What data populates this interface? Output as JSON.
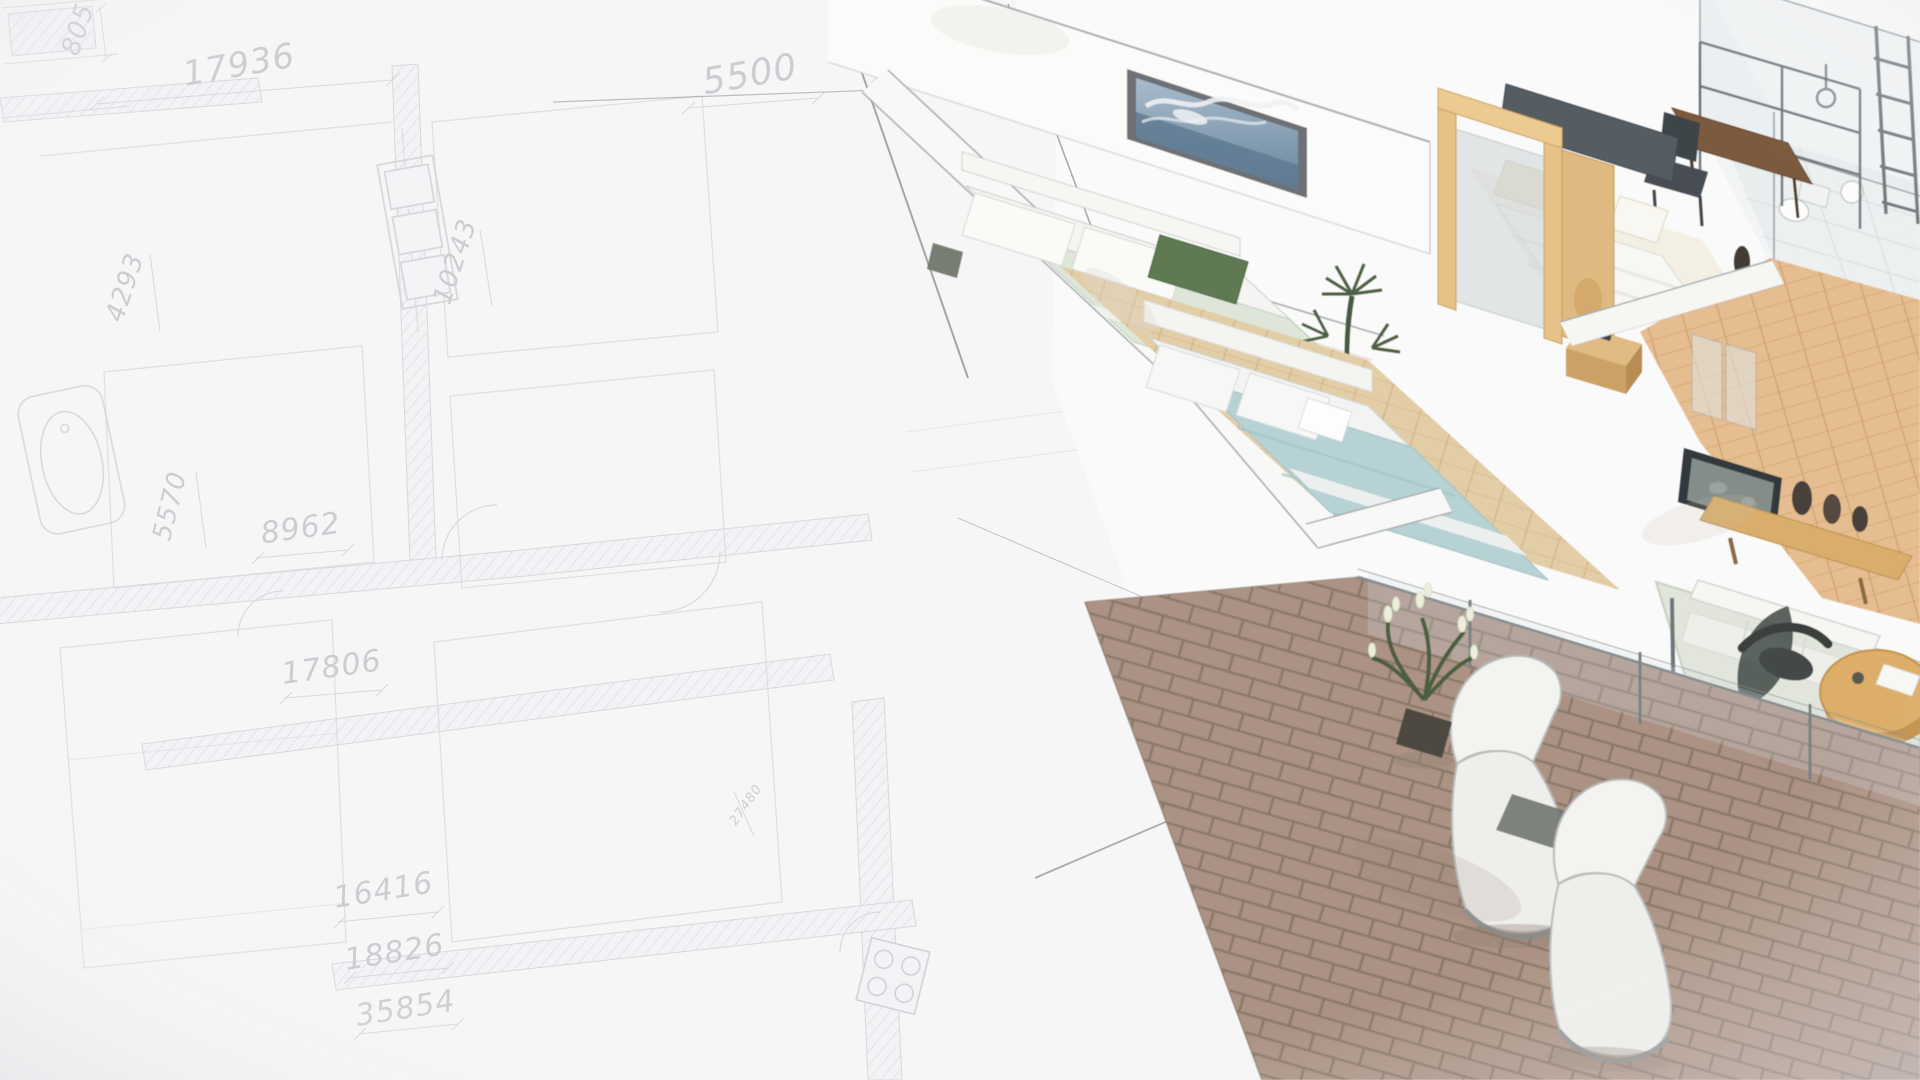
{
  "palette": {
    "paper": "#f6f6f7",
    "blueprint_ink": "#d3d4d9",
    "pencil": "#95989d",
    "dimension_text": "#c2c4c9",
    "wall_white": "#f8f8f5",
    "wood_light": "#e6c288",
    "floor_wood": "#e3cda6",
    "hall_wood": "#e5bd90",
    "brick": "#ab9284",
    "bed_blue": "#b7d2d4",
    "bed_sage": "#dde6d8",
    "pillow_green": "#5e7a52",
    "cream": "#ece3cf",
    "dark_furniture": "#474d52",
    "tv_dark": "#31373a",
    "glass": "#dce6e9",
    "plant_green": "#4d5f43",
    "table_wood": "#dcae67",
    "headboard_gray": "#555c62",
    "sea_painting_blue": "#6884 9b"
  },
  "blueprint": {
    "dimensions": [
      {
        "name": "dim-805",
        "value": "805"
      },
      {
        "name": "dim-17936",
        "value": "17936"
      },
      {
        "name": "dim-5500",
        "value": "5500"
      },
      {
        "name": "dim-2189",
        "value": "2189"
      },
      {
        "name": "dim-4293",
        "value": "4293"
      },
      {
        "name": "dim-10243",
        "value": "10243"
      },
      {
        "name": "dim-5570",
        "value": "5570"
      },
      {
        "name": "dim-8962",
        "value": "8962"
      },
      {
        "name": "dim-17806",
        "value": "17806"
      },
      {
        "name": "dim-16416",
        "value": "16416"
      },
      {
        "name": "dim-18826",
        "value": "18826"
      },
      {
        "name": "dim-35854",
        "value": "35854"
      },
      {
        "name": "dim-27480",
        "value": "27480"
      }
    ],
    "symbols": [
      "hatched-walls",
      "window-triple",
      "bathtub",
      "stove-4-burner",
      "door-arcs",
      "dimension-lines",
      "construction-pencil-lines"
    ]
  },
  "render": {
    "style": "watercolor isometric cutaway of furnished apartment over pencil floor plan",
    "rooms": [
      "bedroom-1",
      "bedroom-2",
      "bathroom",
      "master-bedroom",
      "hallway",
      "living-room",
      "terrace"
    ],
    "furniture": [
      "wave-painting",
      "double-bed-sage",
      "green-pillow",
      "wardrobe-wood-frame",
      "double-bed-gray-headboard",
      "desk",
      "desk-chair",
      "shelf-frame",
      "shower-glass",
      "toilet",
      "ladder-rack",
      "double-bed-blue",
      "nightstand",
      "tv",
      "media-console",
      "floor-vases",
      "leaf-rug",
      "white-sofa",
      "round-coffee-table",
      "dark-chair",
      "glass-balustrade",
      "lounge-chair",
      "lounge-chair",
      "flowering-plant",
      "cactus-plant",
      "brick-terrace-floor"
    ]
  }
}
